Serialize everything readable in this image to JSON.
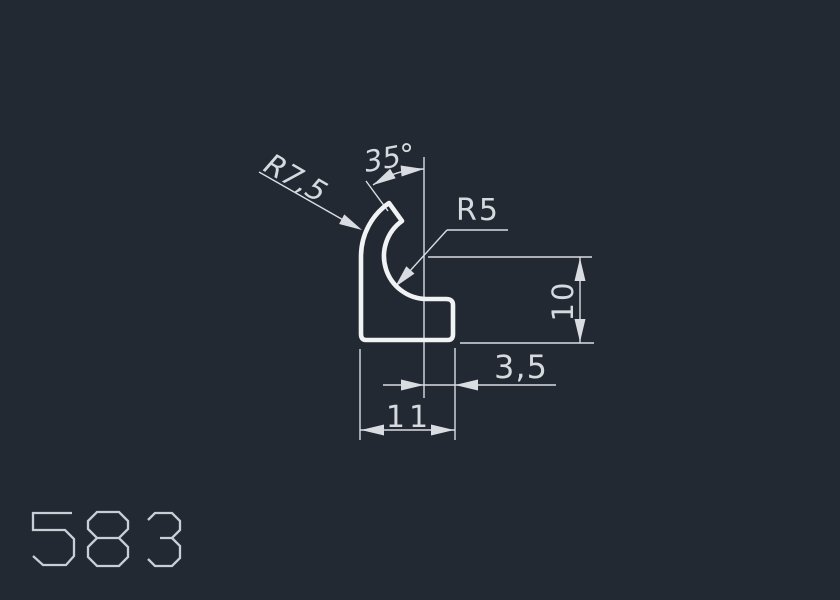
{
  "drawing": {
    "part_number": "583",
    "part_number_paths": [
      "M 72,513 L 33,513 L 33,530 L 65,530 L 74,539 L 74,556 L 66,565 L 43,565 L 33,556",
      "M 97,512 L 119,512 L 128,521 L 128,529 L 119,538 L 97,538 L 88,529 L 88,521 Z M 97,538 L 119,538 L 128,547 L 128,557 L 119,566 L 97,566 L 88,557 L 88,547 Z",
      "M 148,520 L 155,513 L 172,513 L 180,521 L 180,530 L 172,538 L 160,538 M 172,538 L 180,546 L 180,558 L 172,566 L 155,566 L 148,559"
    ],
    "labels": {
      "tip_angle": "35°",
      "outer_radius": "R7,5",
      "inner_radius": "R5",
      "height": "10",
      "lug_width": "3,5",
      "overall_width": "11"
    },
    "colors": {
      "background": "#222933",
      "profile_line": "#f1f2f4",
      "dimension_line": "#d9dde2",
      "dimension_text": "#d6dade",
      "part_number_text": "#c9ced5"
    }
  }
}
